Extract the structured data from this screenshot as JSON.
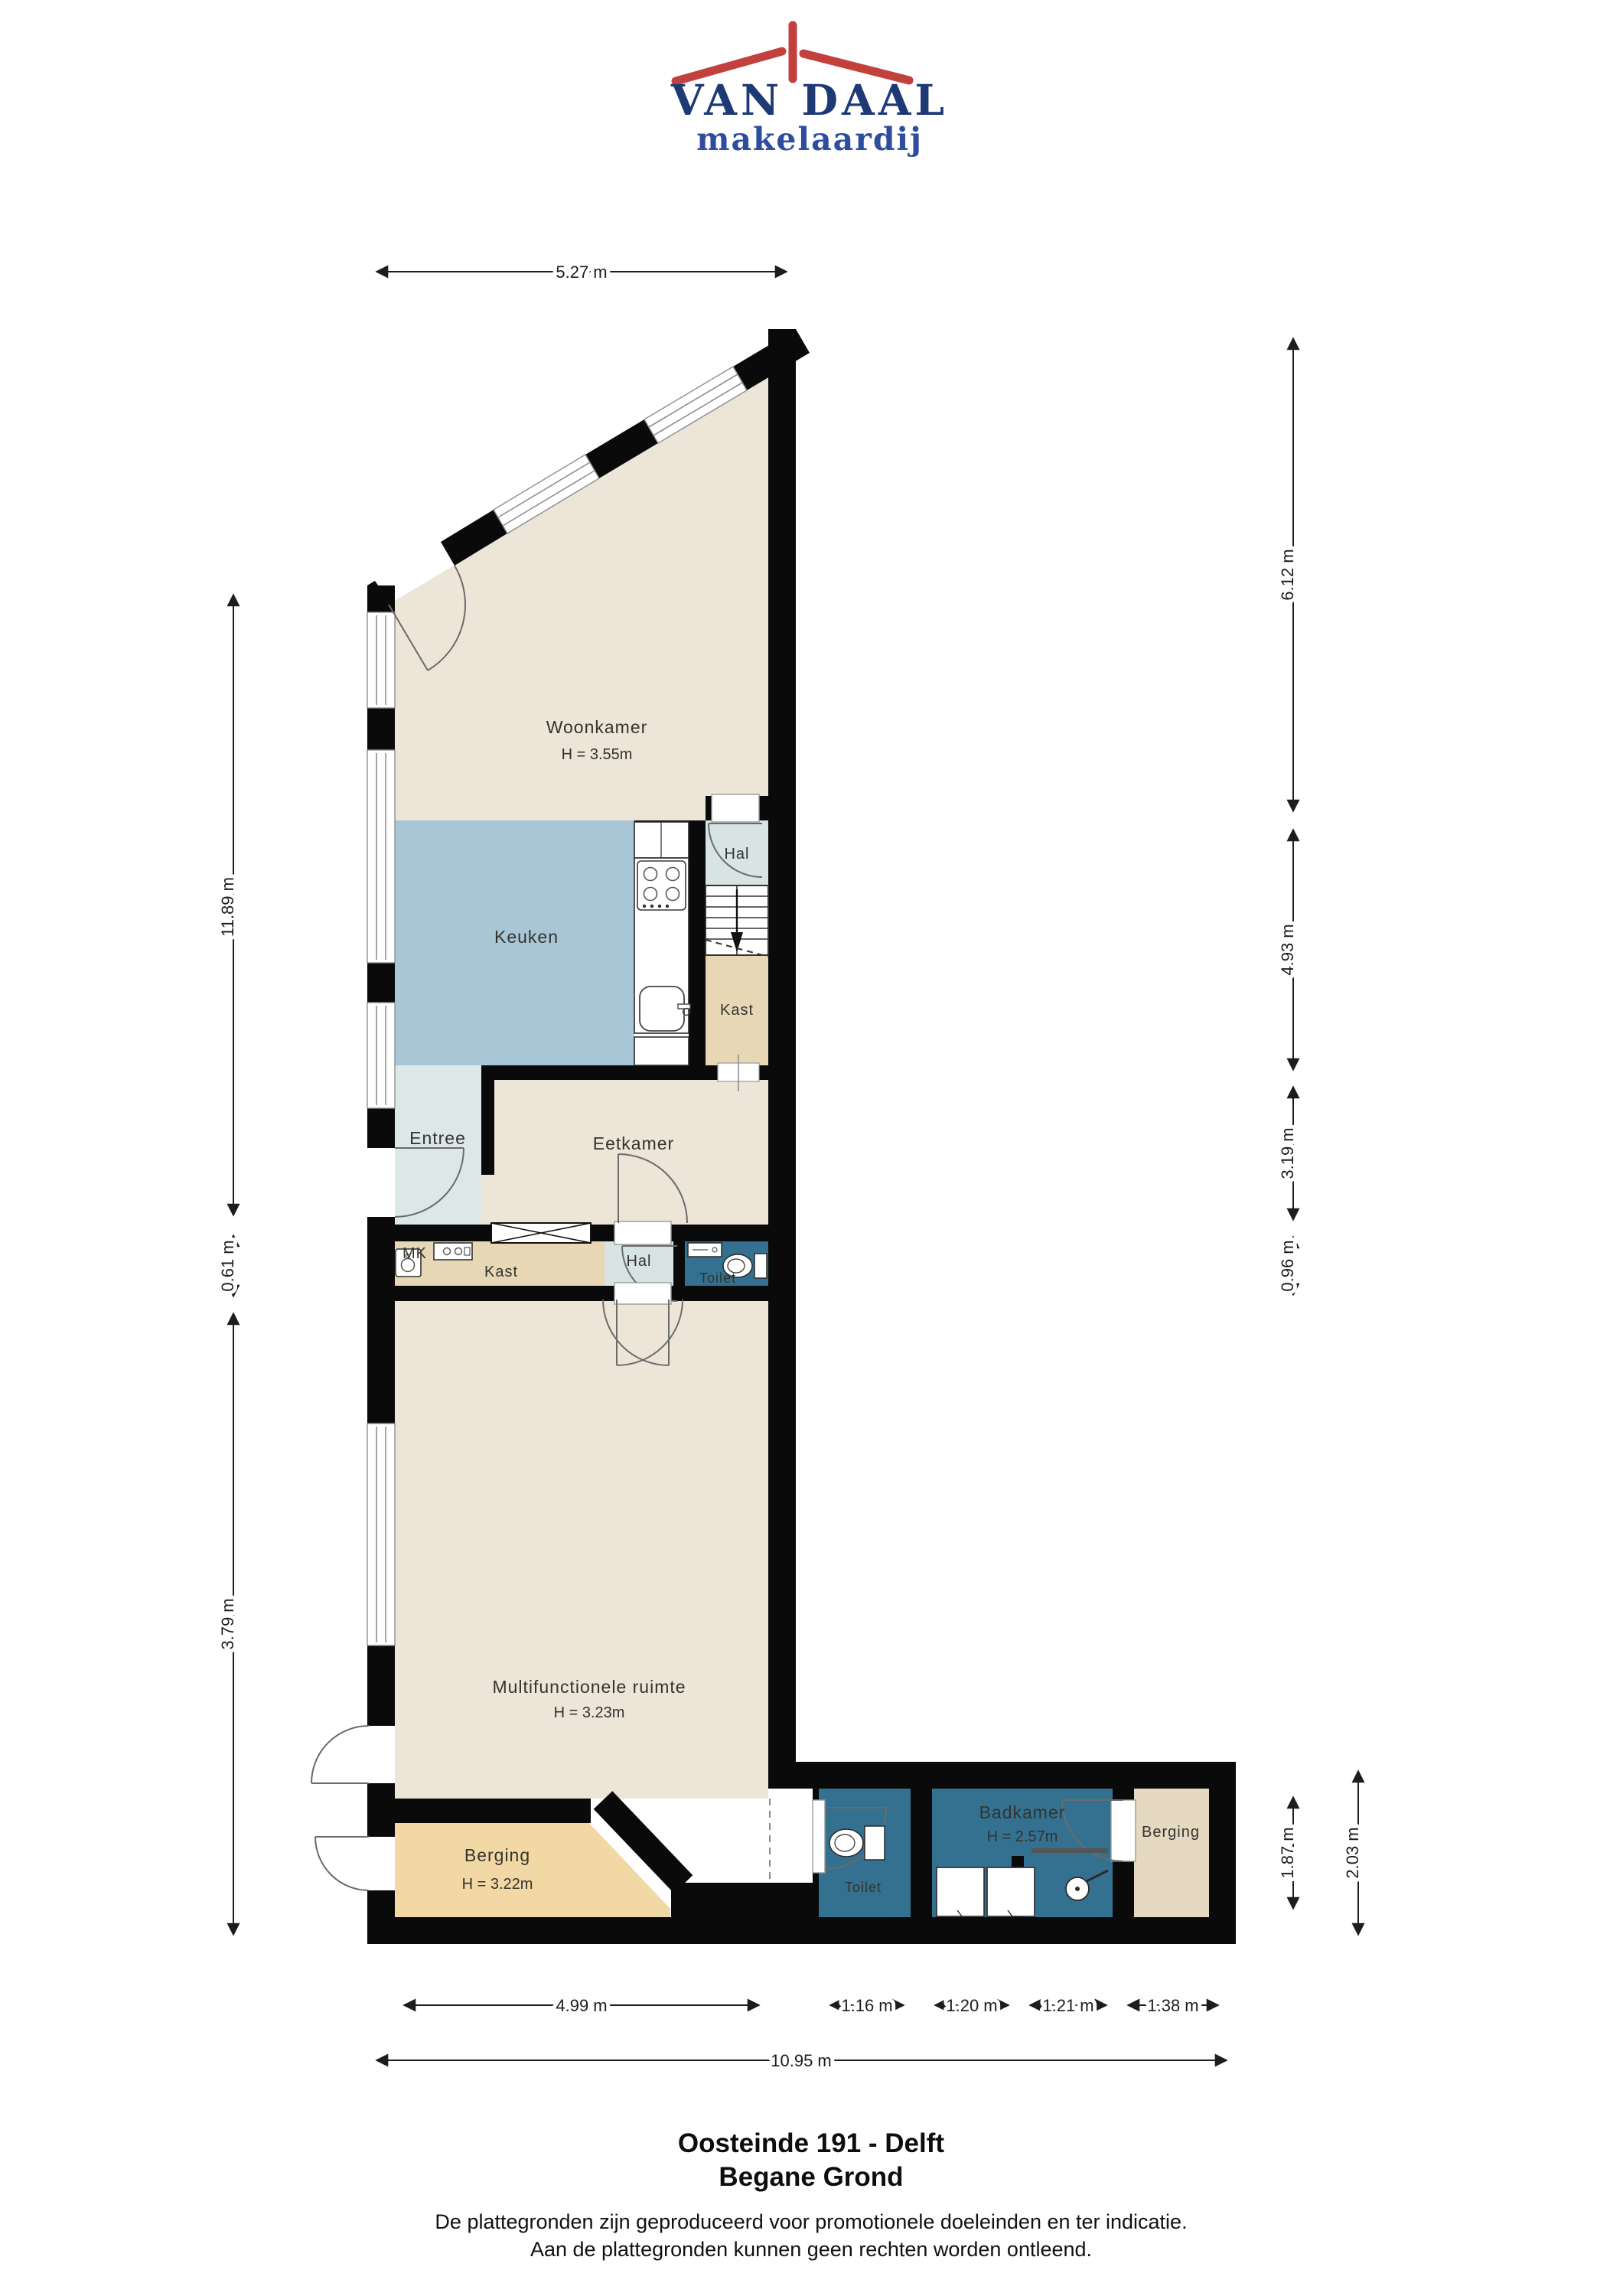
{
  "logo": {
    "title": "VAN DAAL",
    "subtitle": "makelaardij",
    "colors": {
      "roof": "#c2413c",
      "title": "#1e3a75",
      "subtitle": "#2f4d9e"
    }
  },
  "plan": {
    "rooms": {
      "woonkamer": {
        "label": "Woonkamer",
        "height": "H = 3.55m"
      },
      "keuken": {
        "label": "Keuken"
      },
      "hal_boven": {
        "label": "Hal"
      },
      "kast_trap": {
        "label": "Kast"
      },
      "entree": {
        "label": "Entree"
      },
      "eetkamer": {
        "label": "Eetkamer"
      },
      "mk": {
        "label": "MK"
      },
      "kast_midden": {
        "label": "Kast"
      },
      "hal_midden": {
        "label": "Hal"
      },
      "toilet_midden": {
        "label": "Toilet"
      },
      "multifunctionele_ruimte": {
        "label": "Multifunctionele ruimte",
        "height": "H = 3.23m"
      },
      "berging_links": {
        "label": "Berging",
        "height": "H = 3.22m"
      },
      "toilet_onder": {
        "label": "Toilet"
      },
      "badkamer": {
        "label": "Badkamer",
        "height": "H = 2.57m"
      },
      "berging_rechts": {
        "label": "Berging"
      }
    },
    "dimensions": {
      "top_width": "5.27 m",
      "left": [
        "11.89 m",
        "0.61 m",
        "3.79 m"
      ],
      "right": [
        "6.12 m",
        "4.93 m",
        "3.19 m",
        "0.96 m"
      ],
      "wing_right": [
        "1.87 m",
        "2.03 m"
      ],
      "bottom": [
        "4.99 m",
        "1.16 m",
        "1.20 m",
        "1.21 m",
        "1.38 m"
      ],
      "bottom_total": "10.95 m"
    },
    "colors": {
      "floor_cream": "#ece5d8",
      "floor_kitchen": "#a8c6d6",
      "floor_hal": "#d8e4e4",
      "floor_tan": "#e7d7b5",
      "floor_dark_blue": "#34708f",
      "floor_orange": "#f2d8a4",
      "floor_beige": "#e5d9c1",
      "wall": "#0a0a0a"
    }
  },
  "footer": {
    "title": "Oosteinde 191 - Delft",
    "subtitle": "Begane Grond",
    "disclaimer_line1": "De plattegronden zijn geproduceerd voor promotionele doeleinden en ter indicatie.",
    "disclaimer_line2": "Aan de plattegronden kunnen geen rechten worden ontleend."
  }
}
